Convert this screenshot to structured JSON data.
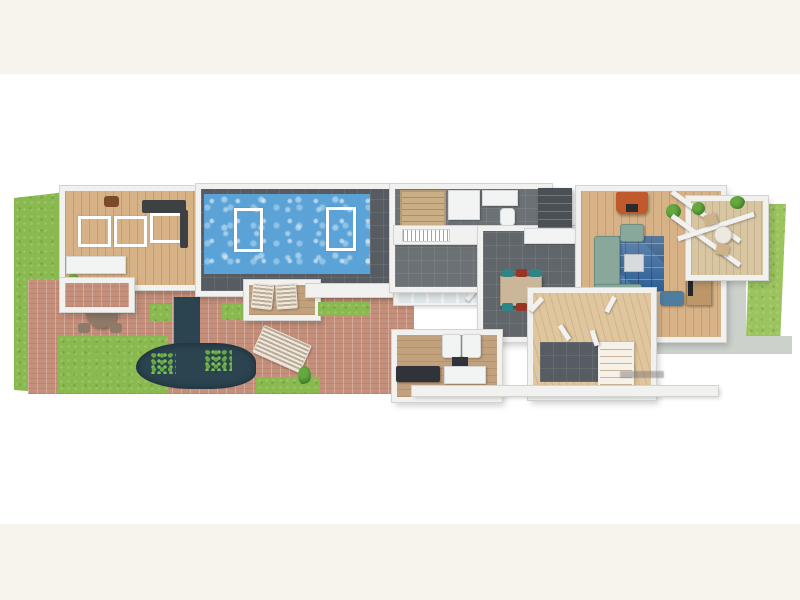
{
  "meta": {
    "description_of_pixels": "3D rendered single-storey floor plan, letterboxed on cream background, no readable text except a tiny illegible grey watermark near the front entrance"
  },
  "palette": {
    "cream": "#f7f4ee",
    "white": "#ffffff",
    "wallFace": "#f1f1f0",
    "wallEdge": "#d3d3d1",
    "woodLight": "#d7b287",
    "woodEntry": "#e0c69e",
    "woodIsland": "#cbb699",
    "woodDesk": "#bd9768",
    "tilePool": "#565c62",
    "tileBath": "#6b7175",
    "tileKitchen": "#60666a",
    "poolWater": "#5ba3d7",
    "lawn": "#8aba4f",
    "lawnLight": "#9bc45e",
    "deckSalmon": "#c4907b",
    "deckTan": "#c2a17e",
    "patioTan": "#d8c5a2",
    "pond": "#2b4450",
    "lily": "#64a83f",
    "sofaSage": "#8aa79b",
    "rugBlue": "#2c5e94",
    "fireplaceOrange": "#c05a2c",
    "chairTeal": "#2f8486",
    "chairRed": "#993526",
    "armchairSteel": "#4f7d9e",
    "armchairBrown": "#7a4a2b",
    "benchDark": "#30343a",
    "equipDark": "#3e4144",
    "concrete": "#ccd1cc",
    "saunaWood": "#c9ae86",
    "charcoal": "#4b5054",
    "glass": "#dfe7ea",
    "fixtureWhite": "#f2f4f4",
    "tableGrey": "#8e7a68",
    "coffeeTableGrey": "#d8dbdd",
    "watermarkGrey": "rgba(110,110,110,0.45)"
  },
  "scene": {
    "island_chair_colors": [
      "chairTeal",
      "chairRed",
      "chairTeal",
      "chairTeal",
      "chairRed",
      "chairTeal"
    ],
    "icons": [
      "pool-icon",
      "pond-icon",
      "sofa-icon",
      "fireplace-icon",
      "staircase-icon",
      "sun-lounger-icon",
      "dining-table-icon",
      "plant-icon",
      "pergola-icon"
    ]
  }
}
